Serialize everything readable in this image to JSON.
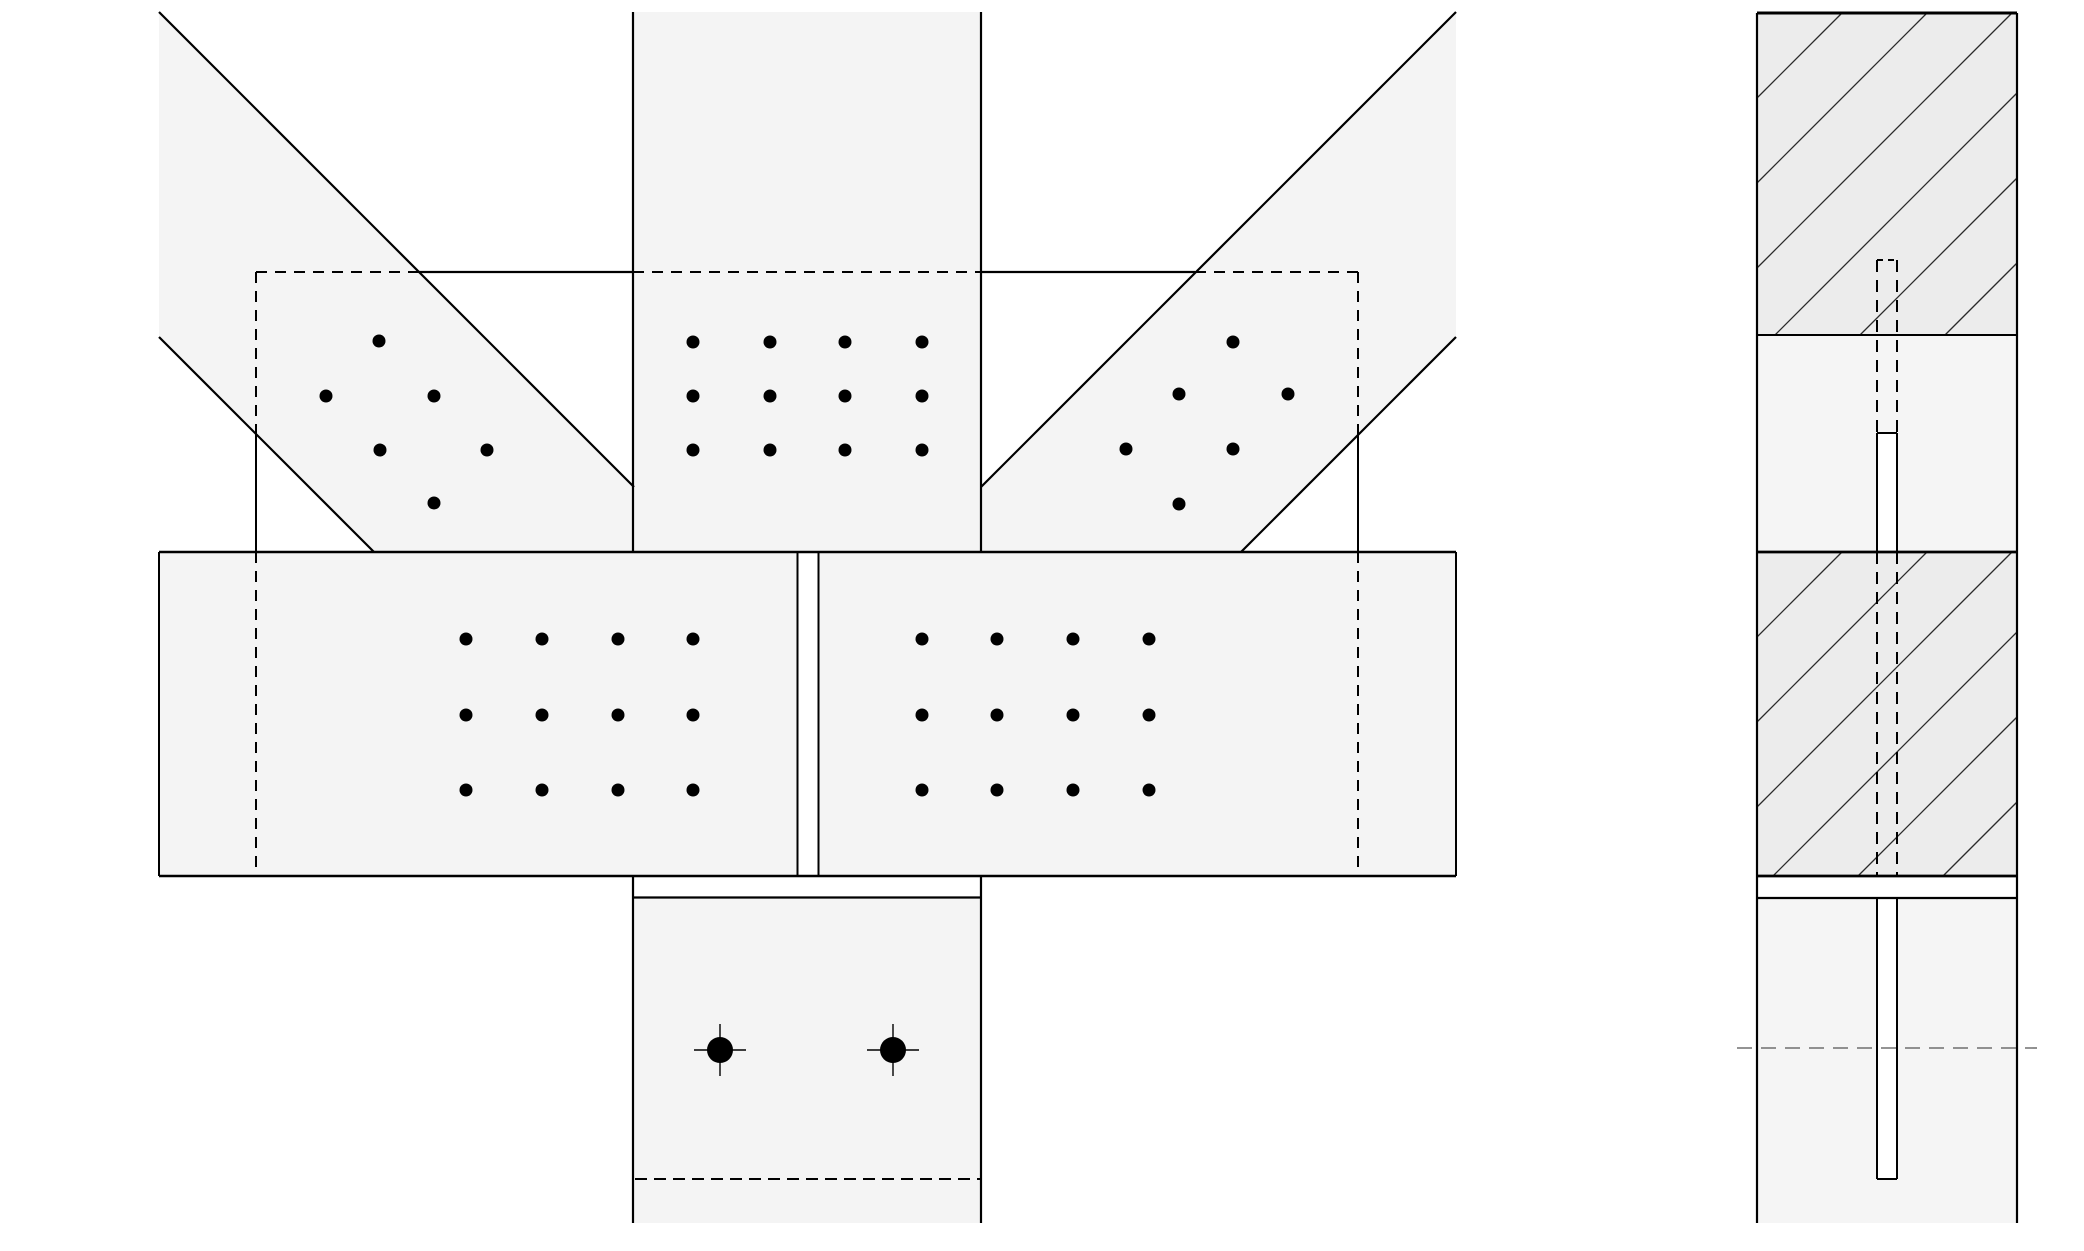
{
  "canvas": {
    "width": 2084,
    "height": 1251,
    "background": "#ffffff"
  },
  "colors": {
    "member_fill": "#f4f4f4",
    "hatched_fill": "#ececec",
    "plain_fill": "#f5f5f5",
    "white": "#ffffff",
    "stroke": "#000000",
    "hatch_stroke": "#2a2a2a",
    "centerline_stroke": "#555555"
  },
  "front_view": {
    "members": [
      {
        "name": "left-brace",
        "points": [
          [
            159,
            12
          ],
          [
            634,
            487
          ],
          [
            634,
            552
          ],
          [
            374,
            552
          ],
          [
            159,
            337
          ]
        ]
      },
      {
        "name": "column",
        "points": [
          [
            633,
            12
          ],
          [
            981,
            12
          ],
          [
            981,
            552
          ],
          [
            633,
            552
          ]
        ]
      },
      {
        "name": "right-brace",
        "points": [
          [
            1456,
            12
          ],
          [
            981,
            487
          ],
          [
            981,
            552
          ],
          [
            1241,
            552
          ],
          [
            1456,
            337
          ]
        ]
      },
      {
        "name": "beam",
        "points": [
          [
            159,
            552
          ],
          [
            1456,
            552
          ],
          [
            1456,
            876
          ],
          [
            159,
            876
          ]
        ]
      },
      {
        "name": "stub-column",
        "points": [
          [
            633,
            876
          ],
          [
            981,
            876
          ],
          [
            981,
            1223
          ],
          [
            633,
            1223
          ]
        ]
      }
    ],
    "white_rects": [
      {
        "name": "beam-splice-gap",
        "x": 798.5,
        "y": 553,
        "w": 19,
        "h": 322
      },
      {
        "name": "stub-top-gap",
        "x": 634.5,
        "y": 877.5,
        "w": 345,
        "h": 19
      }
    ],
    "solid_lines": [
      {
        "name": "left-brace-outer-edge",
        "x1": 159,
        "y1": 12,
        "x2": 634,
        "y2": 487,
        "w": 2.2
      },
      {
        "name": "left-brace-inner-edge",
        "x1": 159,
        "y1": 337,
        "x2": 374,
        "y2": 552,
        "w": 2.2
      },
      {
        "name": "right-brace-outer-edge",
        "x1": 1456,
        "y1": 12,
        "x2": 981,
        "y2": 487,
        "w": 2.2
      },
      {
        "name": "right-brace-inner-edge",
        "x1": 1456,
        "y1": 337,
        "x2": 1241,
        "y2": 552,
        "w": 2.2
      },
      {
        "name": "column-left-edge",
        "x1": 633,
        "y1": 12,
        "x2": 633,
        "y2": 552,
        "w": 2.2
      },
      {
        "name": "column-right-edge",
        "x1": 981,
        "y1": 12,
        "x2": 981,
        "y2": 552,
        "w": 2.2
      },
      {
        "name": "beam-top-edge",
        "x1": 159,
        "y1": 552,
        "x2": 1456,
        "y2": 552,
        "w": 2.6
      },
      {
        "name": "beam-bottom-edge",
        "x1": 159,
        "y1": 876,
        "x2": 1456,
        "y2": 876,
        "w": 2.6
      },
      {
        "name": "beam-left-end",
        "x1": 159,
        "y1": 552,
        "x2": 159,
        "y2": 876,
        "w": 2
      },
      {
        "name": "beam-right-end",
        "x1": 1456,
        "y1": 552,
        "x2": 1456,
        "y2": 876,
        "w": 2
      },
      {
        "name": "splice-gap-left-edge",
        "x1": 797.5,
        "y1": 552,
        "x2": 797.5,
        "y2": 876,
        "w": 2
      },
      {
        "name": "splice-gap-right-edge",
        "x1": 818.5,
        "y1": 552,
        "x2": 818.5,
        "y2": 876,
        "w": 2
      },
      {
        "name": "gusset-top-visible-left",
        "x1": 419,
        "y1": 272,
        "x2": 633,
        "y2": 272,
        "w": 2.2
      },
      {
        "name": "gusset-top-visible-right",
        "x1": 981,
        "y1": 272,
        "x2": 1195,
        "y2": 272,
        "w": 2.2
      },
      {
        "name": "gusset-left-visible",
        "x1": 256,
        "y1": 433,
        "x2": 256,
        "y2": 552,
        "w": 2
      },
      {
        "name": "gusset-right-visible",
        "x1": 1358,
        "y1": 430,
        "x2": 1358,
        "y2": 552,
        "w": 2
      },
      {
        "name": "stub-left-edge",
        "x1": 633,
        "y1": 876,
        "x2": 633,
        "y2": 1223,
        "w": 2.2
      },
      {
        "name": "stub-right-edge",
        "x1": 981,
        "y1": 876,
        "x2": 981,
        "y2": 1223,
        "w": 2.2
      },
      {
        "name": "stub-cap-plate-line",
        "x1": 633,
        "y1": 897.5,
        "x2": 981,
        "y2": 897.5,
        "w": 2.2
      }
    ],
    "dashed_lines": [
      {
        "name": "gusset-top-hidden-under-left-brace",
        "x1": 256,
        "y1": 272,
        "x2": 419,
        "y2": 272,
        "w": 2,
        "dash": "11 8"
      },
      {
        "name": "gusset-top-hidden-under-column",
        "x1": 633,
        "y1": 272,
        "x2": 981,
        "y2": 272,
        "w": 2,
        "dash": "11 8"
      },
      {
        "name": "gusset-top-hidden-under-right-brace",
        "x1": 1195,
        "y1": 272,
        "x2": 1358,
        "y2": 272,
        "w": 2,
        "dash": "11 8"
      },
      {
        "name": "gusset-left-hidden-upper",
        "x1": 256,
        "y1": 272,
        "x2": 256,
        "y2": 433,
        "w": 2,
        "dash": "11 8"
      },
      {
        "name": "gusset-left-hidden-in-beam",
        "x1": 256,
        "y1": 552,
        "x2": 256,
        "y2": 876,
        "w": 2,
        "dash": "11 8"
      },
      {
        "name": "gusset-right-hidden-upper",
        "x1": 1358,
        "y1": 272,
        "x2": 1358,
        "y2": 430,
        "w": 2,
        "dash": "11 8"
      },
      {
        "name": "gusset-right-hidden-in-beam",
        "x1": 1358,
        "y1": 552,
        "x2": 1358,
        "y2": 876,
        "w": 2,
        "dash": "11 8"
      },
      {
        "name": "stub-hidden-plate-edge",
        "x1": 635,
        "y1": 1179,
        "x2": 980,
        "y2": 1179,
        "w": 1.9,
        "dash": "12 7"
      }
    ],
    "bolt_radius": 6.5,
    "bolt_groups": [
      {
        "name": "column-bolt-group",
        "points": [
          [
            693,
            342
          ],
          [
            770,
            342
          ],
          [
            845,
            342
          ],
          [
            922,
            342
          ],
          [
            693,
            396
          ],
          [
            770,
            396
          ],
          [
            845,
            396
          ],
          [
            922,
            396
          ],
          [
            693,
            450
          ],
          [
            770,
            450
          ],
          [
            845,
            450
          ],
          [
            922,
            450
          ]
        ]
      },
      {
        "name": "beam-left-bolt-group",
        "points": [
          [
            466,
            639
          ],
          [
            542,
            639
          ],
          [
            618,
            639
          ],
          [
            693,
            639
          ],
          [
            466,
            715
          ],
          [
            542,
            715
          ],
          [
            618,
            715
          ],
          [
            693,
            715
          ],
          [
            466,
            790
          ],
          [
            542,
            790
          ],
          [
            618,
            790
          ],
          [
            693,
            790
          ]
        ]
      },
      {
        "name": "beam-right-bolt-group",
        "points": [
          [
            922,
            639
          ],
          [
            997,
            639
          ],
          [
            1073,
            639
          ],
          [
            1149,
            639
          ],
          [
            922,
            715
          ],
          [
            997,
            715
          ],
          [
            1073,
            715
          ],
          [
            1149,
            715
          ],
          [
            922,
            790
          ],
          [
            997,
            790
          ],
          [
            1073,
            790
          ],
          [
            1149,
            790
          ]
        ]
      },
      {
        "name": "left-brace-bolt-group",
        "points": [
          [
            379,
            341
          ],
          [
            326,
            396
          ],
          [
            434,
            396
          ],
          [
            380,
            450
          ],
          [
            487,
            450
          ],
          [
            434,
            503
          ]
        ]
      },
      {
        "name": "right-brace-bolt-group",
        "points": [
          [
            1233,
            342
          ],
          [
            1179,
            394
          ],
          [
            1288,
            394
          ],
          [
            1126,
            449
          ],
          [
            1233,
            449
          ],
          [
            1179,
            504
          ]
        ]
      }
    ],
    "anchor_bolts": {
      "radius": 13,
      "tick": 26,
      "tick_w": 1.4,
      "points": [
        [
          720,
          1050
        ],
        [
          893,
          1050
        ]
      ]
    }
  },
  "side_view": {
    "panel": {
      "x0": 1757,
      "x1": 2017,
      "y0": 13,
      "y1": 1223
    },
    "blocks": [
      {
        "name": "side-top-hatched-block",
        "y0": 13,
        "y1": 335,
        "fill": "hatched",
        "hatch_phase": 70
      },
      {
        "name": "side-upper-plain-block",
        "y0": 335,
        "y1": 552,
        "fill": "plain"
      },
      {
        "name": "side-beam-hatched-block",
        "y0": 552,
        "y1": 876,
        "fill": "hatched",
        "hatch_phase": 14
      },
      {
        "name": "side-gap-band",
        "y0": 876,
        "y1": 898,
        "fill": "white"
      },
      {
        "name": "side-bottom-plain-block",
        "y0": 898,
        "y1": 1223,
        "fill": "plain"
      }
    ],
    "block_lines": [
      {
        "name": "side-top-cap-line",
        "y": 13,
        "w": 3
      },
      {
        "name": "side-block-line-335",
        "y": 335,
        "w": 2
      },
      {
        "name": "side-block-line-552",
        "y": 552,
        "w": 2.8
      },
      {
        "name": "side-block-line-876",
        "y": 876,
        "w": 2.8
      },
      {
        "name": "side-block-line-898",
        "y": 898,
        "w": 2.2
      }
    ],
    "edge_w": 2.2,
    "hatch": {
      "spacing": 85,
      "stroke_w": 1.3
    },
    "slot": {
      "x0": 1877,
      "x1": 1897,
      "dashed_segments": [
        {
          "name": "slot-hidden-upper",
          "y0": 260,
          "y1": 433
        },
        {
          "name": "slot-hidden-in-beam",
          "y0": 552,
          "y1": 876
        }
      ],
      "dashed_cap_y": 260,
      "dash": "12 8",
      "dash_w": 2,
      "solid_boxes": [
        {
          "name": "slot-visible-upper",
          "y0": 433,
          "y1": 552,
          "cap": "top"
        },
        {
          "name": "slot-visible-lower",
          "y0": 898,
          "y1": 1179,
          "cap": "bottom"
        }
      ],
      "solid_w": 2
    },
    "centerline": {
      "x0": 1737,
      "x1": 2037,
      "y": 1048,
      "dash": "15 9",
      "w": 1.3
    }
  }
}
